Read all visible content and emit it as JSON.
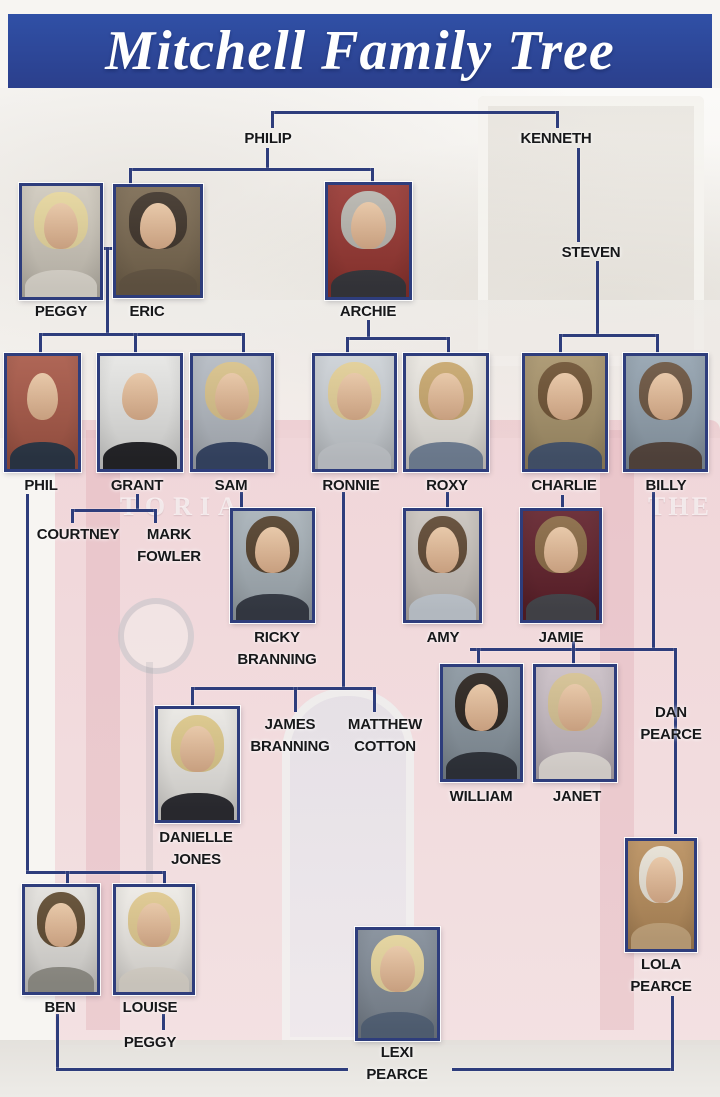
{
  "title": "Mitchell Family Tree",
  "colors": {
    "banner_blue": "#2c4397",
    "line_navy": "#2e3d7c",
    "label_black": "#17181a",
    "photo_border_navy": "#2e3d7c",
    "pub_pink": "#e7aab6"
  },
  "background": {
    "description": "faded photograph of the Queen Vic pub",
    "sign_fragments": [
      "TORIA",
      "THE"
    ]
  },
  "text_nodes": [
    {
      "id": "philip",
      "label": "PHILIP",
      "cx": 268,
      "y": 128
    },
    {
      "id": "kenneth",
      "label": "KENNETH",
      "cx": 556,
      "y": 128
    },
    {
      "id": "steven",
      "label": "STEVEN",
      "cx": 591,
      "y": 242
    },
    {
      "id": "courtney",
      "label": "COURTNEY",
      "cx": 78,
      "y": 524
    },
    {
      "id": "mark-fowler",
      "label": "MARK\nFOWLER",
      "cx": 169,
      "y": 524
    },
    {
      "id": "james-branning",
      "label": "JAMES\nBRANNING",
      "cx": 290,
      "y": 714
    },
    {
      "id": "matthew-cotton",
      "label": "MATTHEW\nCOTTON",
      "cx": 385,
      "y": 714
    },
    {
      "id": "dan-pearce",
      "label": "DAN\nPEARCE",
      "cx": 671,
      "y": 702
    },
    {
      "id": "peggy-jr",
      "label": "PEGGY",
      "cx": 150,
      "y": 1032
    }
  ],
  "people": [
    {
      "id": "peggy",
      "label": "PEGGY",
      "x": 19,
      "y": 183,
      "w": 84,
      "h": 117,
      "lx": 61,
      "ly": 301,
      "palette": {
        "bg": "#cfc9bd",
        "hair": "#e7d79e",
        "top": "#e9e4da"
      }
    },
    {
      "id": "eric",
      "label": "ERIC",
      "x": 113,
      "y": 184,
      "w": 90,
      "h": 114,
      "lx": 147,
      "ly": 301,
      "palette": {
        "bg": "#7b6a52",
        "hair": "#3f342a",
        "top": "#6b5c49"
      }
    },
    {
      "id": "archie",
      "label": "ARCHIE",
      "x": 325,
      "y": 182,
      "w": 87,
      "h": 118,
      "lx": 368,
      "ly": 301,
      "palette": {
        "bg": "#983833",
        "hair": "#b9b7b0",
        "top": "#3a3a40"
      }
    },
    {
      "id": "phil",
      "label": "PHIL",
      "x": 4,
      "y": 353,
      "w": 77,
      "h": 119,
      "lx": 41,
      "ly": 475,
      "palette": {
        "bg": "#a85948",
        "hair": null,
        "top": "#2e3a4a"
      }
    },
    {
      "id": "grant",
      "label": "GRANT",
      "x": 97,
      "y": 353,
      "w": 86,
      "h": 119,
      "lx": 137,
      "ly": 475,
      "palette": {
        "bg": "#e6e6e4",
        "hair": null,
        "top": "#26262a"
      }
    },
    {
      "id": "sam",
      "label": "SAM",
      "x": 190,
      "y": 353,
      "w": 84,
      "h": 119,
      "lx": 231,
      "ly": 475,
      "palette": {
        "bg": "#b4bac2",
        "hair": "#d9c28a",
        "top": "#3a4a6b"
      }
    },
    {
      "id": "ronnie",
      "label": "RONNIE",
      "x": 312,
      "y": 353,
      "w": 85,
      "h": 119,
      "lx": 351,
      "ly": 475,
      "palette": {
        "bg": "#ccd1d6",
        "hair": "#e3cf97",
        "top": "#cfd3d8"
      }
    },
    {
      "id": "roxy",
      "label": "ROXY",
      "x": 403,
      "y": 353,
      "w": 86,
      "h": 119,
      "lx": 447,
      "ly": 475,
      "palette": {
        "bg": "#e9e6e0",
        "hair": "#c9a86e",
        "top": "#7a8aa0"
      }
    },
    {
      "id": "charlie",
      "label": "CHARLIE",
      "x": 522,
      "y": 353,
      "w": 86,
      "h": 119,
      "lx": 564,
      "ly": 475,
      "palette": {
        "bg": "#a8946c",
        "hair": "#6e5233",
        "top": "#4a5a74"
      }
    },
    {
      "id": "billy",
      "label": "BILLY",
      "x": 623,
      "y": 353,
      "w": 85,
      "h": 119,
      "lx": 666,
      "ly": 475,
      "palette": {
        "bg": "#93a2af",
        "hair": "#6b5440",
        "top": "#5a4a42"
      }
    },
    {
      "id": "ricky-branning",
      "label": "RICKY\nBRANNING",
      "x": 230,
      "y": 508,
      "w": 85,
      "h": 115,
      "lx": 277,
      "ly": 627,
      "palette": {
        "bg": "#a7b1b8",
        "hair": "#53402c",
        "top": "#3a3f4a"
      }
    },
    {
      "id": "amy",
      "label": "AMY",
      "x": 403,
      "y": 508,
      "w": 79,
      "h": 115,
      "lx": 443,
      "ly": 627,
      "palette": {
        "bg": "#c9c3bd",
        "hair": "#5f4833",
        "top": "#cfd6de"
      }
    },
    {
      "id": "jamie",
      "label": "JAMIE",
      "x": 520,
      "y": 508,
      "w": 82,
      "h": 115,
      "lx": 561,
      "ly": 627,
      "palette": {
        "bg": "#62222c",
        "hair": "#8a6a45",
        "top": "#4a4a50"
      }
    },
    {
      "id": "william",
      "label": "WILLIAM",
      "x": 440,
      "y": 664,
      "w": 83,
      "h": 118,
      "lx": 481,
      "ly": 786,
      "palette": {
        "bg": "#8a96a0",
        "hair": "#2a231e",
        "top": "#32363e"
      }
    },
    {
      "id": "janet",
      "label": "JANET",
      "x": 533,
      "y": 664,
      "w": 84,
      "h": 118,
      "lx": 577,
      "ly": 786,
      "palette": {
        "bg": "#c9bec5",
        "hair": "#d6c293",
        "top": "#efe9e4"
      }
    },
    {
      "id": "danielle-jones",
      "label": "DANIELLE\nJONES",
      "x": 155,
      "y": 706,
      "w": 85,
      "h": 117,
      "lx": 196,
      "ly": 827,
      "palette": {
        "bg": "#e9e7e3",
        "hair": "#dcc789",
        "top": "#2e2e34"
      }
    },
    {
      "id": "ben",
      "label": "BEN",
      "x": 22,
      "y": 884,
      "w": 78,
      "h": 111,
      "lx": 60,
      "ly": 997,
      "palette": {
        "bg": "#e2e0dc",
        "hair": "#5f4a30",
        "top": "#9a9890"
      }
    },
    {
      "id": "louise",
      "label": "LOUISE",
      "x": 113,
      "y": 884,
      "w": 82,
      "h": 111,
      "lx": 150,
      "ly": 997,
      "palette": {
        "bg": "#edeae5",
        "hair": "#e0c98f",
        "top": "#e8e2d8"
      }
    },
    {
      "id": "lola-pearce",
      "label": "LOLA\nPEARCE",
      "x": 625,
      "y": 838,
      "w": 72,
      "h": 114,
      "lx": 661,
      "ly": 954,
      "palette": {
        "bg": "#b98f5e",
        "hair": "#e8e2d6",
        "top": "#cfae83"
      }
    },
    {
      "id": "lexi-pearce",
      "label": "LEXI\nPEARCE",
      "x": 355,
      "y": 927,
      "w": 85,
      "h": 114,
      "lx": 397,
      "ly": 1042,
      "palette": {
        "bg": "#828c98",
        "hair": "#e5d49c",
        "top": "#5a6a80"
      }
    }
  ],
  "lines": [
    {
      "x": 271,
      "y": 111,
      "w": 288,
      "h": 3
    },
    {
      "x": 271,
      "y": 111,
      "w": 3,
      "h": 17
    },
    {
      "x": 556,
      "y": 111,
      "w": 3,
      "h": 17
    },
    {
      "x": 266,
      "y": 148,
      "w": 3,
      "h": 22
    },
    {
      "x": 129,
      "y": 168,
      "w": 245,
      "h": 3
    },
    {
      "x": 129,
      "y": 168,
      "w": 3,
      "h": 18
    },
    {
      "x": 371,
      "y": 168,
      "w": 3,
      "h": 16
    },
    {
      "x": 577,
      "y": 148,
      "w": 3,
      "h": 94
    },
    {
      "x": 596,
      "y": 261,
      "w": 3,
      "h": 75
    },
    {
      "x": 559,
      "y": 334,
      "w": 100,
      "h": 3
    },
    {
      "x": 559,
      "y": 334,
      "w": 3,
      "h": 20
    },
    {
      "x": 656,
      "y": 334,
      "w": 3,
      "h": 20
    },
    {
      "x": 100,
      "y": 247,
      "w": 16,
      "h": 3
    },
    {
      "x": 106,
      "y": 247,
      "w": 3,
      "h": 89
    },
    {
      "x": 39,
      "y": 333,
      "w": 206,
      "h": 3
    },
    {
      "x": 39,
      "y": 333,
      "w": 3,
      "h": 21
    },
    {
      "x": 134,
      "y": 333,
      "w": 3,
      "h": 21
    },
    {
      "x": 242,
      "y": 333,
      "w": 3,
      "h": 21
    },
    {
      "x": 367,
      "y": 320,
      "w": 3,
      "h": 19
    },
    {
      "x": 346,
      "y": 337,
      "w": 104,
      "h": 3
    },
    {
      "x": 346,
      "y": 337,
      "w": 3,
      "h": 17
    },
    {
      "x": 447,
      "y": 337,
      "w": 3,
      "h": 17
    },
    {
      "x": 26,
      "y": 494,
      "w": 3,
      "h": 379
    },
    {
      "x": 136,
      "y": 494,
      "w": 3,
      "h": 17
    },
    {
      "x": 71,
      "y": 509,
      "w": 86,
      "h": 3
    },
    {
      "x": 71,
      "y": 509,
      "w": 3,
      "h": 14
    },
    {
      "x": 154,
      "y": 509,
      "w": 3,
      "h": 14
    },
    {
      "x": 240,
      "y": 492,
      "w": 3,
      "h": 16
    },
    {
      "x": 342,
      "y": 492,
      "w": 3,
      "h": 197
    },
    {
      "x": 446,
      "y": 492,
      "w": 3,
      "h": 16
    },
    {
      "x": 561,
      "y": 495,
      "w": 3,
      "h": 13
    },
    {
      "x": 652,
      "y": 492,
      "w": 3,
      "h": 159
    },
    {
      "x": 470,
      "y": 648,
      "w": 207,
      "h": 3
    },
    {
      "x": 477,
      "y": 648,
      "w": 3,
      "h": 17
    },
    {
      "x": 572,
      "y": 641,
      "w": 3,
      "h": 24
    },
    {
      "x": 674,
      "y": 648,
      "w": 3,
      "h": 186
    },
    {
      "x": 191,
      "y": 687,
      "w": 185,
      "h": 3
    },
    {
      "x": 191,
      "y": 687,
      "w": 3,
      "h": 19
    },
    {
      "x": 294,
      "y": 687,
      "w": 3,
      "h": 25
    },
    {
      "x": 373,
      "y": 687,
      "w": 3,
      "h": 25
    },
    {
      "x": 26,
      "y": 871,
      "w": 140,
      "h": 3
    },
    {
      "x": 66,
      "y": 871,
      "w": 3,
      "h": 14
    },
    {
      "x": 163,
      "y": 871,
      "w": 3,
      "h": 14
    },
    {
      "x": 162,
      "y": 1014,
      "w": 3,
      "h": 16
    },
    {
      "x": 56,
      "y": 1014,
      "w": 3,
      "h": 56
    },
    {
      "x": 56,
      "y": 1068,
      "w": 292,
      "h": 3
    },
    {
      "x": 452,
      "y": 1068,
      "w": 222,
      "h": 3
    },
    {
      "x": 671,
      "y": 996,
      "w": 3,
      "h": 75
    }
  ]
}
